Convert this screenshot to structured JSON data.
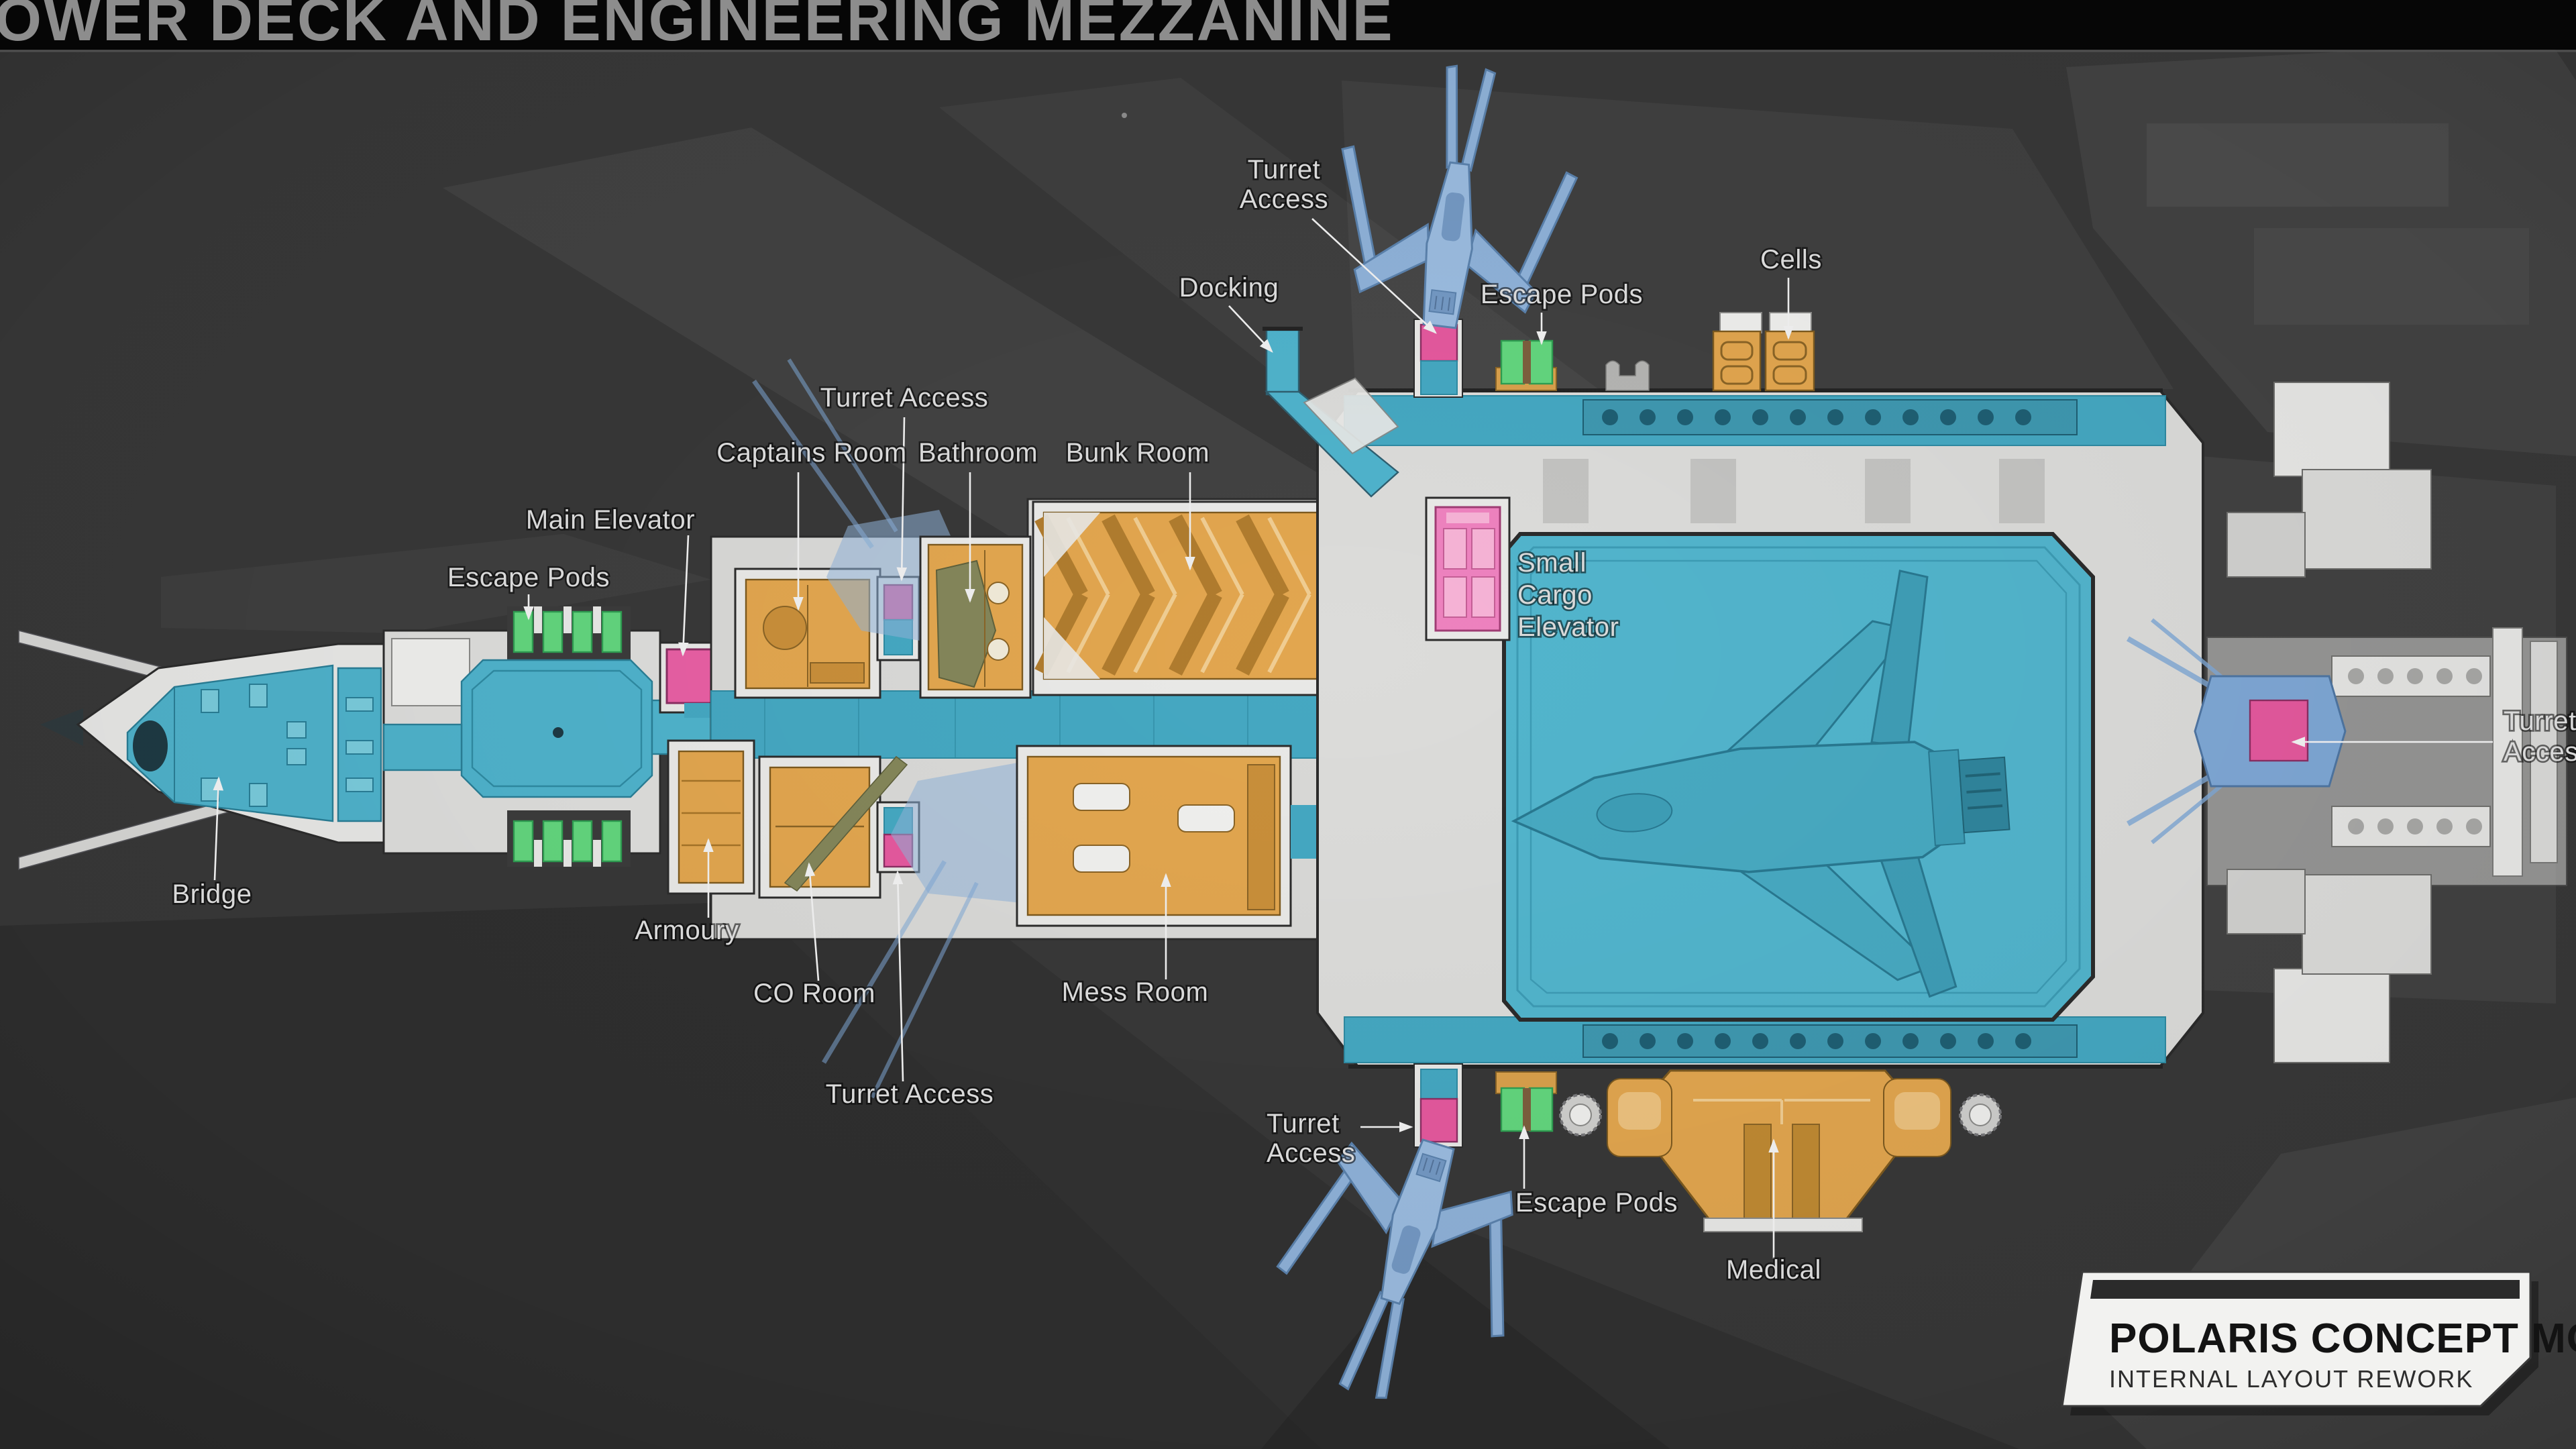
{
  "header": {
    "title": "OWER DECK AND ENGINEERING MEZZANINE"
  },
  "banner": {
    "title": "POLARIS CONCEPT MODEL",
    "subtitle": "INTERNAL LAYOUT REWORK"
  },
  "labels": {
    "turret_access_top": {
      "line1": "Turret",
      "line2": "Access"
    },
    "docking": {
      "text": "Docking"
    },
    "escape_pods_top": {
      "text": "Escape Pods"
    },
    "cells": {
      "text": "Cells"
    },
    "turret_access_mid": {
      "text": "Turret Access"
    },
    "captains_room": {
      "text": "Captains Room"
    },
    "bathroom": {
      "text": "Bathroom"
    },
    "bunk_room": {
      "text": "Bunk Room"
    },
    "main_elevator": {
      "text": "Main Elevator"
    },
    "escape_pods_left": {
      "text": "Escape Pods"
    },
    "small_cargo_elevator": {
      "line1": "Small",
      "line2": "Cargo",
      "line3": "Elevator"
    },
    "turret_access_right": {
      "line1": "Turret",
      "line2": "Access"
    },
    "bridge": {
      "text": "Bridge"
    },
    "armoury": {
      "text": "Armoury"
    },
    "co_room": {
      "text": "CO Room"
    },
    "mess_room": {
      "text": "Mess Room"
    },
    "turret_access_bottom": {
      "text": "Turret Access"
    },
    "turret_access_bottom_left": {
      "line1": "Turret",
      "line2": "Access"
    },
    "escape_pods_bottom": {
      "text": "Escape Pods"
    },
    "medical": {
      "text": "Medical"
    }
  },
  "colors": {
    "background": "#383838",
    "top_bar": "#060606",
    "hull_white": "#e9e9e7",
    "interior_blue": "#4fb3cc",
    "hangar_blue": "#52b5cd",
    "room_orange": "#e2a64f",
    "pod_green": "#63d67e",
    "access_pink": "#e5599e",
    "cargo_elevator_pink": "#ee82bf",
    "docked_fighter_blue": "#8fb2d9",
    "label_text": "#d9d9d9"
  }
}
